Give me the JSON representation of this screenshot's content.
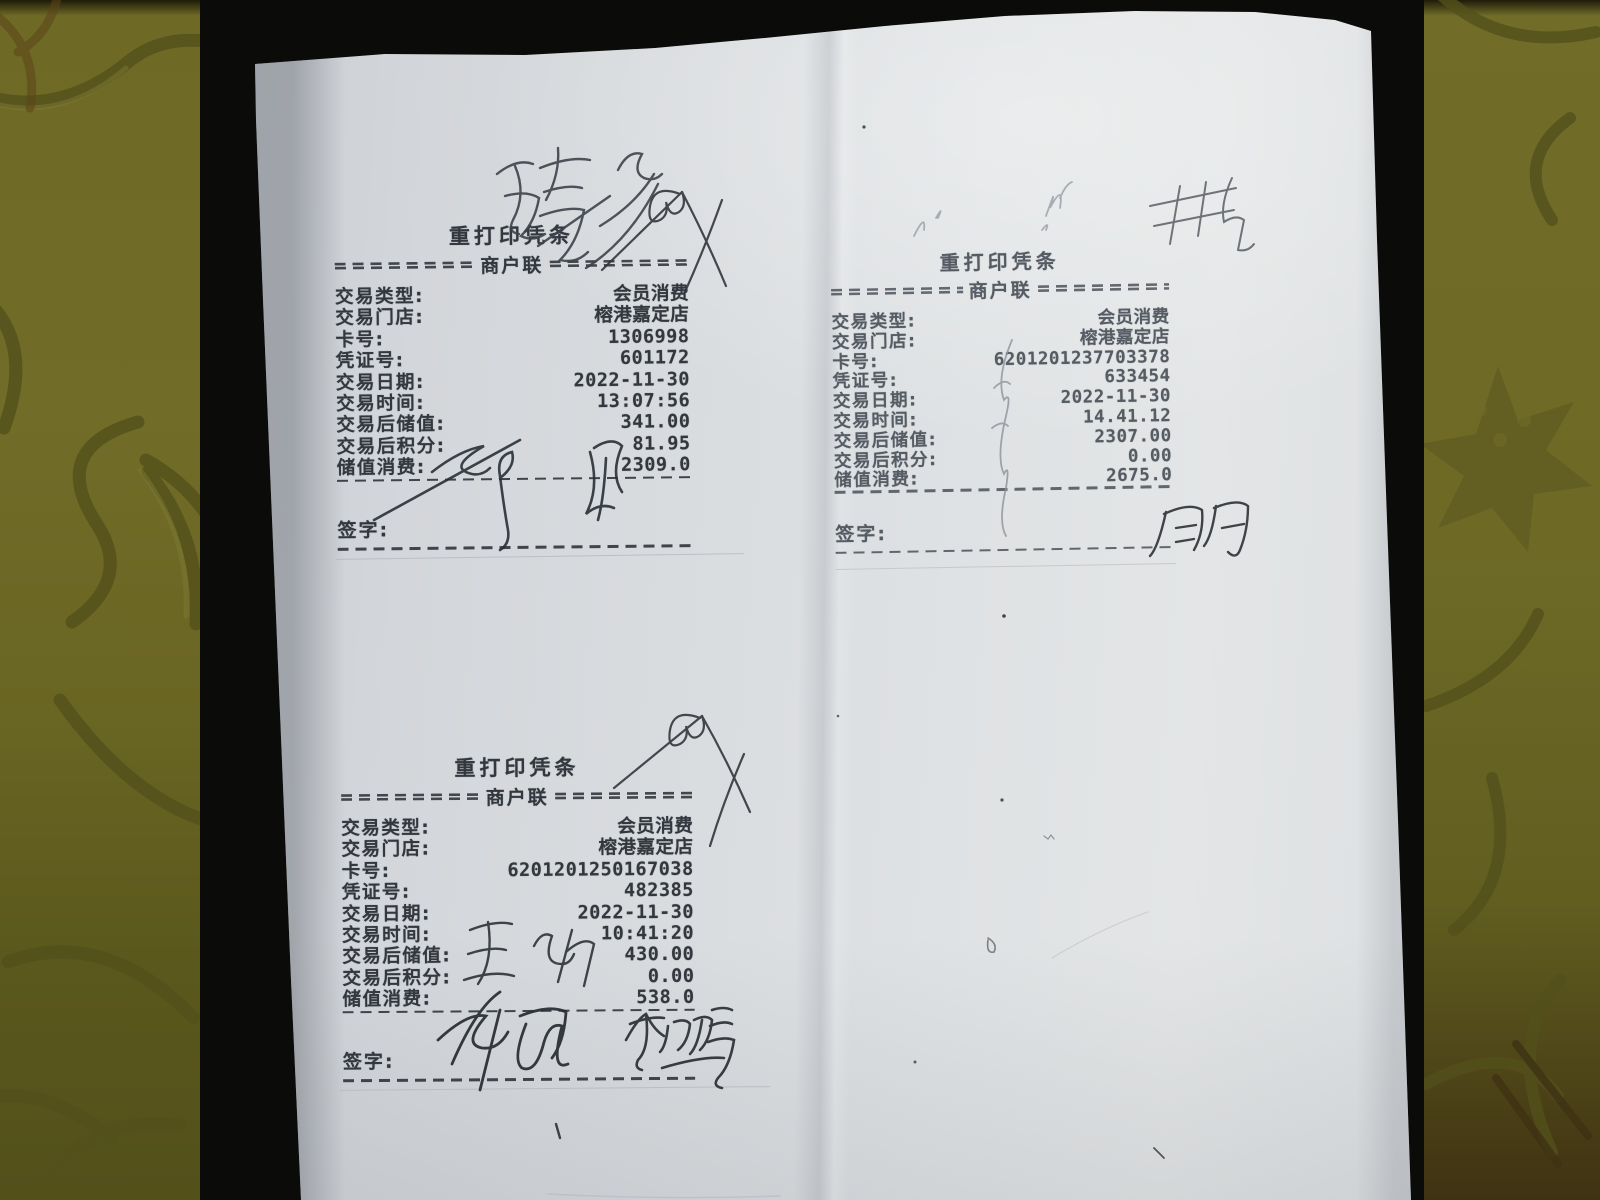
{
  "scene": {
    "kind": "photo of three reprinted POS receipts on a white sheet",
    "colors": {
      "fabric": "#6e6a26",
      "fabric_pattern": "#53501b",
      "mat": "#0b0b09",
      "paper": "#dadde0",
      "print_ink": "#33383e",
      "faint_print_ink": "#565c64",
      "pen_ink": "#2b3036",
      "pencil": "#8d939b"
    }
  },
  "receipts": [
    {
      "position": "top-left",
      "title": "重打印凭条",
      "copy_label": "商户联",
      "sign_label": "签字:",
      "rows": [
        {
          "label": "交易类型:",
          "value": "会员消费"
        },
        {
          "label": "交易门店:",
          "value": "榕港嘉定店"
        },
        {
          "label": "卡号:",
          "value": "1306998"
        },
        {
          "label": "凭证号:",
          "value": "601172"
        },
        {
          "label": "交易日期:",
          "value": "2022-11-30"
        },
        {
          "label": "交易时间:",
          "value": "13:07:56"
        },
        {
          "label": "交易后储值:",
          "value": "341.00"
        },
        {
          "label": "交易后积分:",
          "value": "81.95"
        },
        {
          "label": "储值消费:",
          "value": "2309.0"
        }
      ]
    },
    {
      "position": "top-right",
      "title": "重打印凭条",
      "copy_label": "商户联",
      "sign_label": "签字:",
      "rows": [
        {
          "label": "交易类型:",
          "value": "会员消费"
        },
        {
          "label": "交易门店:",
          "value": "榕港嘉定店"
        },
        {
          "label": "卡号:",
          "value": "6201201237703378"
        },
        {
          "label": "凭证号:",
          "value": "633454"
        },
        {
          "label": "交易日期:",
          "value": "2022-11-30"
        },
        {
          "label": "交易时间:",
          "value": "14.41.12"
        },
        {
          "label": "交易后储值:",
          "value": "2307.00"
        },
        {
          "label": "交易后积分:",
          "value": "0.00"
        },
        {
          "label": "储值消费:",
          "value": "2675.0"
        }
      ]
    },
    {
      "position": "bottom-left",
      "title": "重打印凭条",
      "copy_label": "商户联",
      "sign_label": "签字:",
      "rows": [
        {
          "label": "交易类型:",
          "value": "会员消费"
        },
        {
          "label": "交易门店:",
          "value": "榕港嘉定店"
        },
        {
          "label": "卡号:",
          "value": "6201201250167038"
        },
        {
          "label": "凭证号:",
          "value": "482385"
        },
        {
          "label": "交易日期:",
          "value": "2022-11-30"
        },
        {
          "label": "交易时间:",
          "value": "10:41:20"
        },
        {
          "label": "交易后储值:",
          "value": "430.00"
        },
        {
          "label": "交易后积分:",
          "value": "0.00"
        },
        {
          "label": "储值消费:",
          "value": "538.0"
        }
      ]
    }
  ],
  "handwriting": {
    "name_above_receipt1": "夏春兰",
    "scribble_above_receipt1": "peaked pen scribble with loops",
    "signature_on_receipt1": "illegible cursive signature",
    "pencil_marks_top_right": "faint illegible pencil marks",
    "pencil_scribble_on_receipt2": "faint pencil scribble",
    "signature_receipt2": "周冉",
    "scribble_above_receipt3": "peaked pen scribble with loops",
    "note_on_receipt3_rows": "illegible cursive note",
    "signature_receipt3_left": "徐娟",
    "signature_receipt3_right": "李明清"
  }
}
